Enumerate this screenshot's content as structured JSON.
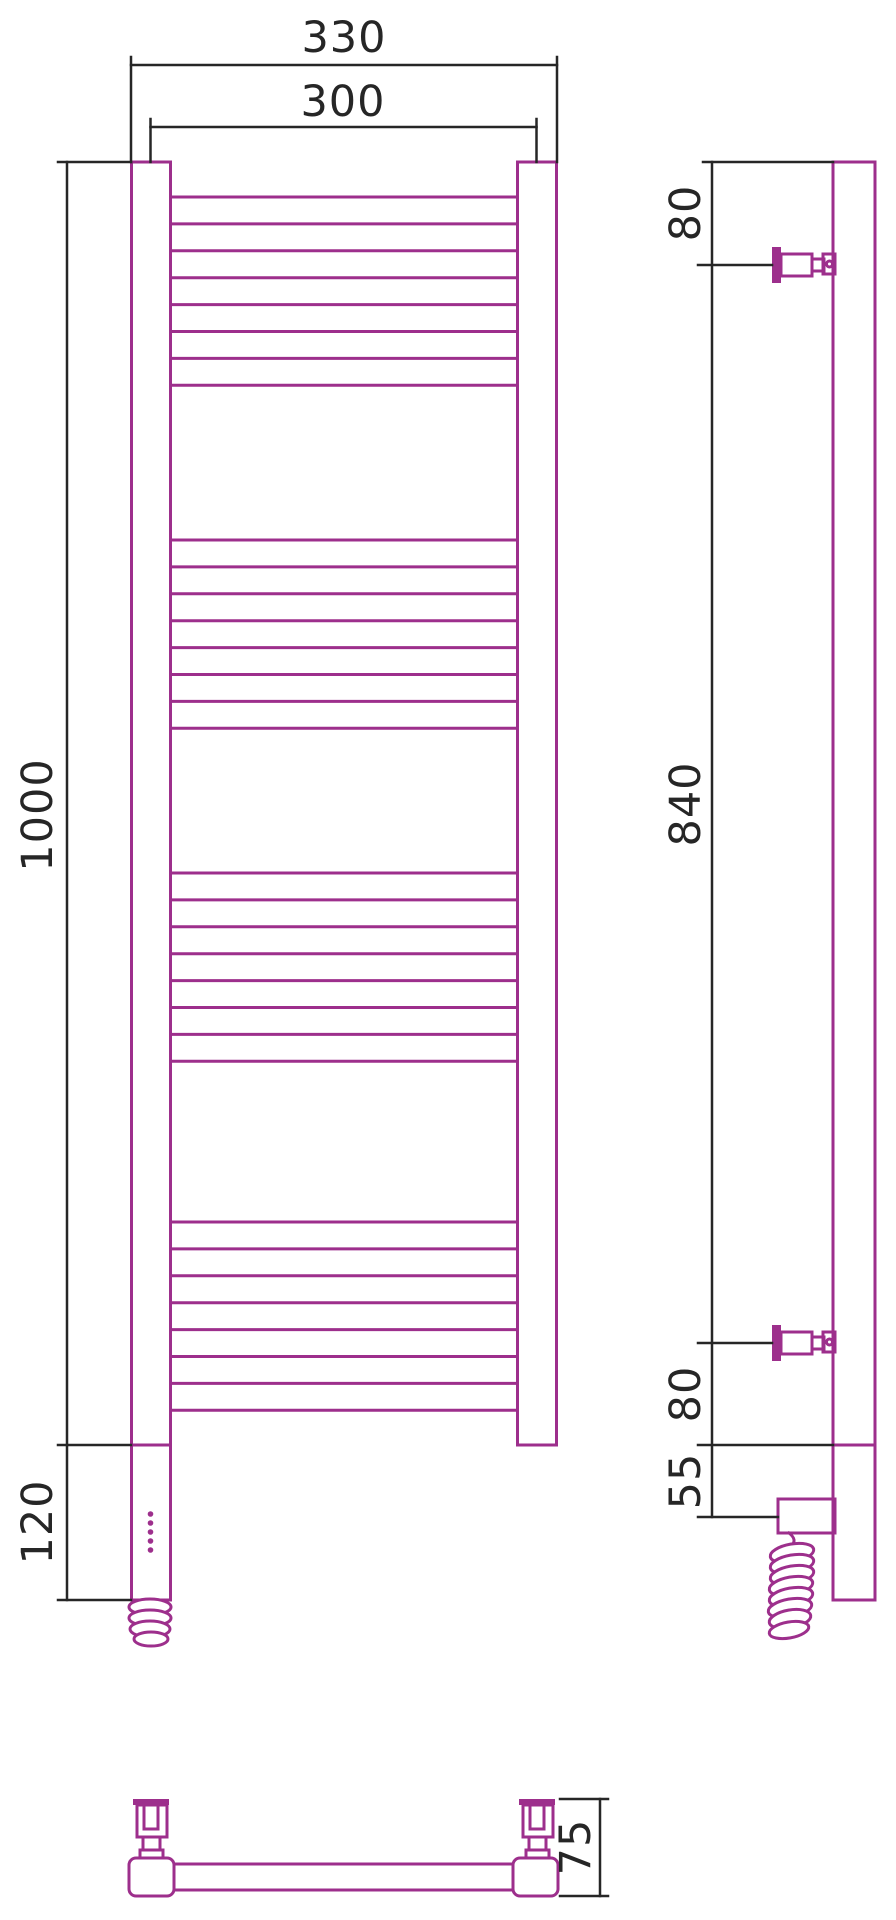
{
  "drawing": {
    "background": "#ffffff",
    "line_color": "#9d2f8c",
    "dim_color": "#262626",
    "front_view": {
      "width_overall_mm": "330",
      "rail_width_mm": "300",
      "height_mm": "1000",
      "heater_section_mm": "120",
      "rungs": {
        "groups": [
          197,
          540,
          873,
          1222
        ],
        "per_group": 8,
        "spacing": 26.9
      }
    },
    "side_view": {
      "top_bracket_offset_mm": "80",
      "bracket_span_mm": "840",
      "bottom_bracket_offset_mm": "80",
      "heater_offset_mm": "55"
    },
    "bottom_view": {
      "depth_mm": "75"
    }
  }
}
